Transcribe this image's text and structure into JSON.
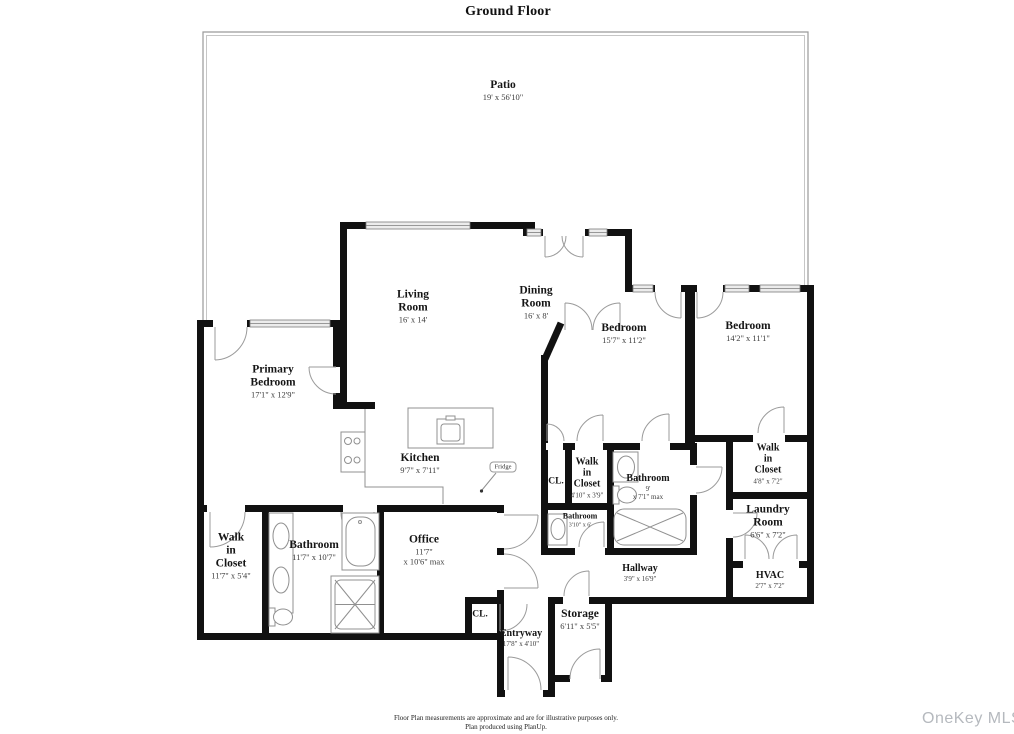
{
  "title": "Ground Floor",
  "rooms": [
    {
      "id": "patio",
      "name": "Patio",
      "dims": "19' x 56'10\""
    },
    {
      "id": "living",
      "name": "Living\nRoom",
      "dims": "16' x 14'"
    },
    {
      "id": "dining",
      "name": "Dining\nRoom",
      "dims": "16' x 8'"
    },
    {
      "id": "bedroom-1",
      "name": "Bedroom",
      "dims": "15'7\" x 11'2\""
    },
    {
      "id": "bedroom-2",
      "name": "Bedroom",
      "dims": "14'2\" x 11'1\""
    },
    {
      "id": "primary-bedroom",
      "name": "Primary\nBedroom",
      "dims": "17'1\" x 12'9\""
    },
    {
      "id": "kitchen",
      "name": "Kitchen",
      "dims": "9'7\" x 7'11\""
    },
    {
      "id": "closet-mid",
      "name": "CL.",
      "dims": ""
    },
    {
      "id": "walk-in-closet-mid",
      "name": "Walk\nin\nCloset",
      "dims": "4'10\" x 3'9\""
    },
    {
      "id": "bathroom-mid",
      "name": "Bathroom",
      "dims": "9'\nx 7'1\" max"
    },
    {
      "id": "walk-in-closet-right",
      "name": "Walk\nin\nCloset",
      "dims": "4'8\" x 7'2\""
    },
    {
      "id": "laundry-room",
      "name": "Laundry\nRoom",
      "dims": "6'6\" x 7'2\""
    },
    {
      "id": "hvac",
      "name": "HVAC",
      "dims": "2'7\" x 7'2\""
    },
    {
      "id": "bathroom-small",
      "name": "Bathroom",
      "dims": "3'10\" x 6'"
    },
    {
      "id": "hallway",
      "name": "Hallway",
      "dims": "3'9\" x 16'9\""
    },
    {
      "id": "walk-in-closet-left",
      "name": "Walk\nin\nCloset",
      "dims": "11'7\" x 5'4\""
    },
    {
      "id": "bathroom-left",
      "name": "Bathroom",
      "dims": "11'7\" x 10'7\""
    },
    {
      "id": "office",
      "name": "Office",
      "dims": "11'7\"\nx 10'6\" max"
    },
    {
      "id": "storage",
      "name": "Storage",
      "dims": "6'11\" x 5'5\""
    },
    {
      "id": "entryway",
      "name": "Entryway",
      "dims": "17'8\" x 4'10\""
    },
    {
      "id": "closet-bottom",
      "name": "CL.",
      "dims": ""
    }
  ],
  "fridge_label": "Fridge",
  "footer": {
    "line1": "Floor Plan measurements are approximate and are for illustrative purposes only.",
    "line2": "Plan produced using PlanUp."
  },
  "watermark": "OneKey MLS",
  "colors": {
    "wall": "#111111",
    "door_arc": "#999999",
    "fixture": "#909090",
    "dims_text": "#3d3d3d",
    "watermark": "#b5b9be"
  }
}
